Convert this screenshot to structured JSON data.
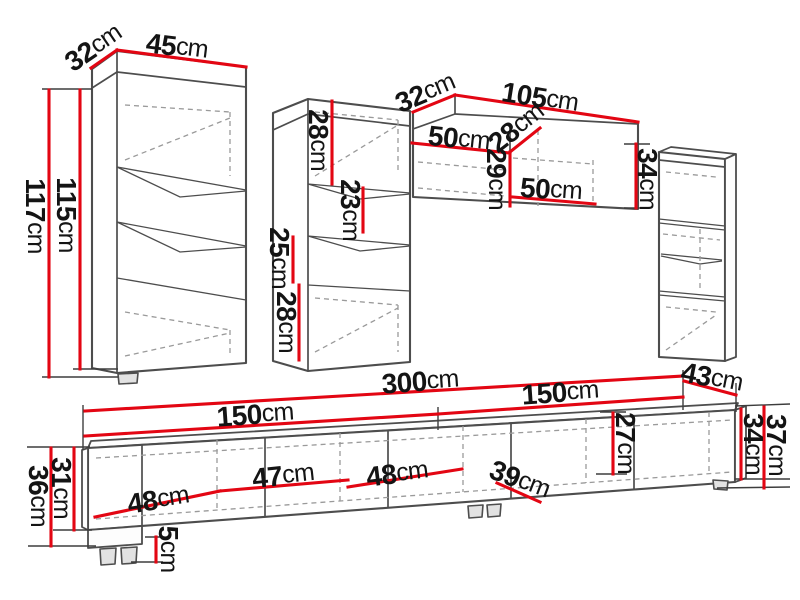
{
  "colors": {
    "accent": "#e30613",
    "line": "#4d4d4d",
    "dash": "#9a9a9a",
    "text": "#141414",
    "background": "#ffffff"
  },
  "unit": "cm",
  "labels": [
    {
      "id": "left-cabinet-depth",
      "value": "32",
      "unit": "cm",
      "x": 93,
      "y": 47,
      "rot": -34,
      "group": "left-cabinet"
    },
    {
      "id": "left-cabinet-width",
      "value": "45",
      "unit": "cm",
      "x": 177,
      "y": 46,
      "rot": 7,
      "group": "left-cabinet"
    },
    {
      "id": "left-cabinet-height-outer",
      "value": "117",
      "unit": "cm",
      "x": 36,
      "y": 216,
      "rot": 90,
      "group": "left-cabinet"
    },
    {
      "id": "left-cabinet-height-inner",
      "value": "115",
      "unit": "cm",
      "x": 67,
      "y": 215,
      "rot": 90,
      "group": "left-cabinet"
    },
    {
      "id": "middle-cabinet-top-section",
      "value": "28",
      "unit": "cm",
      "x": 319,
      "y": 140,
      "rot": 90,
      "group": "middle-cabinet"
    },
    {
      "id": "middle-cabinet-shelf-section",
      "value": "23",
      "unit": "cm",
      "x": 351,
      "y": 210,
      "rot": 90,
      "group": "middle-cabinet"
    },
    {
      "id": "middle-cabinet-gap-section",
      "value": "25",
      "unit": "cm",
      "x": 280,
      "y": 258,
      "rot": 90,
      "group": "middle-cabinet"
    },
    {
      "id": "middle-cabinet-bottom-section",
      "value": "28",
      "unit": "cm",
      "x": 287,
      "y": 322,
      "rot": 90,
      "group": "middle-cabinet"
    },
    {
      "id": "wall-cabinet-depth",
      "value": "32",
      "unit": "cm",
      "x": 425,
      "y": 92,
      "rot": -23,
      "group": "wall-cabinet"
    },
    {
      "id": "wall-cabinet-width",
      "value": "105",
      "unit": "cm",
      "x": 540,
      "y": 97,
      "rot": 9,
      "group": "wall-cabinet"
    },
    {
      "id": "wall-cabinet-inner-width-top",
      "value": "50",
      "unit": "cm",
      "x": 459,
      "y": 138,
      "rot": 6,
      "group": "wall-cabinet"
    },
    {
      "id": "wall-cabinet-inner-depth",
      "value": "28",
      "unit": "cm",
      "x": 516,
      "y": 127,
      "rot": -38,
      "group": "wall-cabinet"
    },
    {
      "id": "wall-cabinet-inner-height",
      "value": "29",
      "unit": "cm",
      "x": 497,
      "y": 179,
      "rot": 90,
      "group": "wall-cabinet"
    },
    {
      "id": "wall-cabinet-inner-width-bottom",
      "value": "50",
      "unit": "cm",
      "x": 551,
      "y": 189,
      "rot": 4,
      "group": "wall-cabinet"
    },
    {
      "id": "wall-cabinet-side-height",
      "value": "34",
      "unit": "cm",
      "x": 648,
      "y": 179,
      "rot": 90,
      "group": "wall-cabinet"
    },
    {
      "id": "tv-stand-total-width",
      "value": "300",
      "unit": "cm",
      "x": 420,
      "y": 381,
      "rot": -4,
      "group": "tv-stand"
    },
    {
      "id": "tv-stand-left-width",
      "value": "150",
      "unit": "cm",
      "x": 255,
      "y": 414,
      "rot": -4,
      "group": "tv-stand"
    },
    {
      "id": "tv-stand-right-width",
      "value": "150",
      "unit": "cm",
      "x": 560,
      "y": 392,
      "rot": -4,
      "group": "tv-stand"
    },
    {
      "id": "tv-stand-depth",
      "value": "43",
      "unit": "cm",
      "x": 712,
      "y": 377,
      "rot": 11,
      "group": "tv-stand"
    },
    {
      "id": "tv-stand-compartment1-width",
      "value": "48",
      "unit": "cm",
      "x": 158,
      "y": 499,
      "rot": -9,
      "group": "tv-stand"
    },
    {
      "id": "tv-stand-compartment2-width",
      "value": "47",
      "unit": "cm",
      "x": 283,
      "y": 475,
      "rot": -6,
      "group": "tv-stand"
    },
    {
      "id": "tv-stand-compartment3-width",
      "value": "48",
      "unit": "cm",
      "x": 397,
      "y": 473,
      "rot": -7,
      "group": "tv-stand"
    },
    {
      "id": "tv-stand-compartment4-depth",
      "value": "39",
      "unit": "cm",
      "x": 520,
      "y": 479,
      "rot": 21,
      "group": "tv-stand"
    },
    {
      "id": "tv-stand-inner-height",
      "value": "27",
      "unit": "cm",
      "x": 626,
      "y": 443,
      "rot": 90,
      "group": "tv-stand"
    },
    {
      "id": "tv-stand-left-height-outer",
      "value": "36",
      "unit": "cm",
      "x": 39,
      "y": 496,
      "rot": 90,
      "group": "tv-stand"
    },
    {
      "id": "tv-stand-left-height-inner",
      "value": "31",
      "unit": "cm",
      "x": 62,
      "y": 488,
      "rot": 90,
      "group": "tv-stand"
    },
    {
      "id": "tv-stand-foot-height",
      "value": "5",
      "unit": "cm",
      "x": 169,
      "y": 549,
      "rot": 90,
      "group": "tv-stand"
    },
    {
      "id": "tv-stand-right-height-inner",
      "value": "34",
      "unit": "cm",
      "x": 754,
      "y": 444,
      "rot": 90,
      "group": "tv-stand"
    },
    {
      "id": "tv-stand-right-height-outer",
      "value": "37",
      "unit": "cm",
      "x": 777,
      "y": 445,
      "rot": 90,
      "group": "tv-stand"
    }
  ]
}
